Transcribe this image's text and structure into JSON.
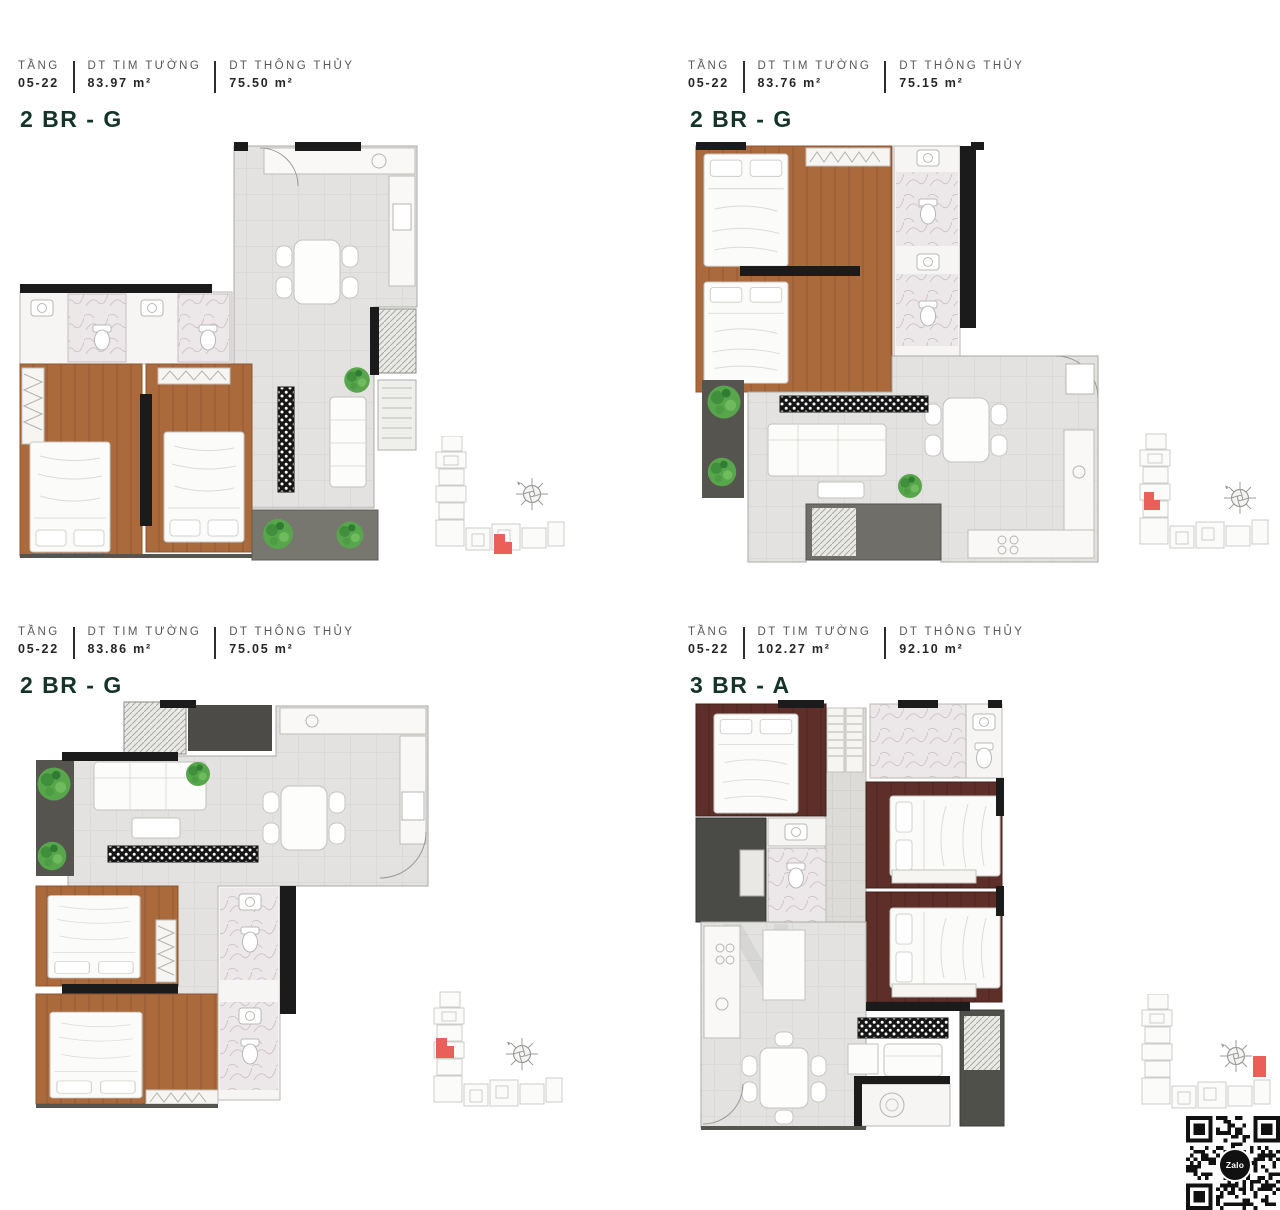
{
  "colors": {
    "unit_label_green": "#143429",
    "header_label_gray": "#575757",
    "header_value_dark": "#262626",
    "keyplan_highlight_red": "#ea5f58",
    "wood_floor_2br": "#ab6a3c",
    "wood_floor_3br": "#5e2f28",
    "tile_floor": "#e3e2e0",
    "wall_black": "#1b1b1b",
    "plant_green": "#58a64b",
    "balcony_gray": "#6f6e68",
    "keyplan_outline": "#cdcdca"
  },
  "panels": [
    {
      "header": {
        "floor_label": "TẦNG",
        "floor_value": "05-22",
        "gross_label": "DT TIM TƯỜNG",
        "gross_value": "83.97 m²",
        "net_label": "DT THÔNG THỦY",
        "net_value": "75.50 m²"
      },
      "unit_label": "2 BR - G",
      "keyplan_highlight": "bottom-wing-center"
    },
    {
      "header": {
        "floor_label": "TẦNG",
        "floor_value": "05-22",
        "gross_label": "DT TIM TƯỜNG",
        "gross_value": "83.76 m²",
        "net_label": "DT THÔNG THỦY",
        "net_value": "75.15 m²"
      },
      "unit_label": "2 BR - G",
      "keyplan_highlight": "left-wing-middle"
    },
    {
      "header": {
        "floor_label": "TẦNG",
        "floor_value": "05-22",
        "gross_label": "DT TIM TƯỜNG",
        "gross_value": "83.86 m²",
        "net_label": "DT THÔNG THỦY",
        "net_value": "75.05 m²"
      },
      "unit_label": "2 BR - G",
      "keyplan_highlight": "left-wing-upper"
    },
    {
      "header": {
        "floor_label": "TẦNG",
        "floor_value": "05-22",
        "gross_label": "DT TIM TƯỜNG",
        "gross_value": "102.27 m²",
        "net_label": "DT THÔNG THỦY",
        "net_value": "92.10 m²"
      },
      "unit_label": "3 BR - A",
      "keyplan_highlight": "right-wing-end"
    }
  ],
  "qr": {
    "label": "Zalo"
  },
  "watermark": "N"
}
